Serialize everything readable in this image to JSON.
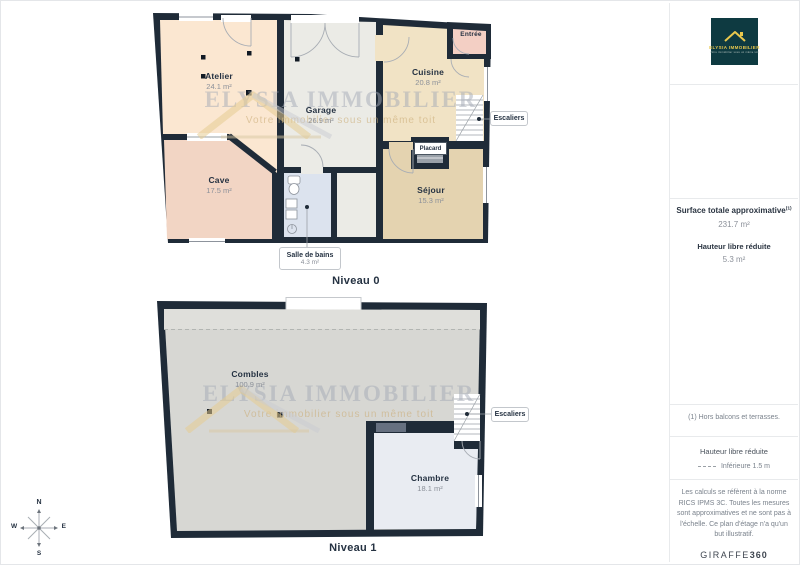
{
  "floor0": {
    "title": "Niveau 0",
    "rooms": {
      "atelier": {
        "name": "Atelier",
        "area": "24.1 m²"
      },
      "garage": {
        "name": "Garage",
        "area": "26.9 m²"
      },
      "cuisine": {
        "name": "Cuisine",
        "area": "20.8 m²"
      },
      "cave": {
        "name": "Cave",
        "area": "17.5 m²"
      },
      "sejour": {
        "name": "Séjour",
        "area": "15.3 m²"
      },
      "salle_de_bains": {
        "name": "Salle de bains",
        "area": "4.3 m²"
      },
      "entree": {
        "name": "Entrée"
      },
      "placard": {
        "name": "Placard"
      }
    },
    "stairs": "Escaliers"
  },
  "floor1": {
    "title": "Niveau 1",
    "rooms": {
      "combles": {
        "name": "Combles",
        "area": "100.9 m²"
      },
      "chambre": {
        "name": "Chambre",
        "area": "18.1 m²"
      }
    },
    "stairs": "Escaliers"
  },
  "watermark": {
    "title": "ELYSIA IMMOBILIER",
    "subtitle": "Votre immobilier sous un même toit"
  },
  "logo": {
    "brand": "ELYSIA IMMOBILIER",
    "tagline": "Votre immobilier sous un même toit"
  },
  "compass": {
    "north": "N",
    "east": "E",
    "south": "S",
    "west": "W"
  },
  "sidebar": {
    "surface_title": "Surface totale approximative",
    "surface_footnote_ref": "(1)",
    "surface_value": "231.7 m²",
    "reduced_height_title": "Hauteur libre réduite",
    "reduced_height_value": "5.3 m²",
    "footnote": "(1) Hors balcons et terrasses.",
    "legend_title": "Hauteur libre réduite",
    "legend_item": "Inférieure 1.5 m",
    "disclaimer": "Les calculs se réfèrent à la norme RICS IPMS 3C. Toutes les mesures sont approximatives et ne sont pas à l'échelle. Ce plan d'étage n'a qu'un but illustratif.",
    "brand": "GIRAFFE",
    "brand_suffix": "360"
  },
  "colors": {
    "wall": "#1f2b38",
    "atelier": "#fbe7d1",
    "garage": "#ebebe6",
    "cuisine": "#f1e3c5",
    "cave": "#f2d5c4",
    "sejour": "#e4d3b0",
    "salle_de_bains": "#dce3ee",
    "entree": "#f3cfc4",
    "combles": "#d7d7d3",
    "chambre": "#e9ecf2",
    "logo_background": "#0e3a41",
    "logo_accent": "#e9c84d"
  }
}
